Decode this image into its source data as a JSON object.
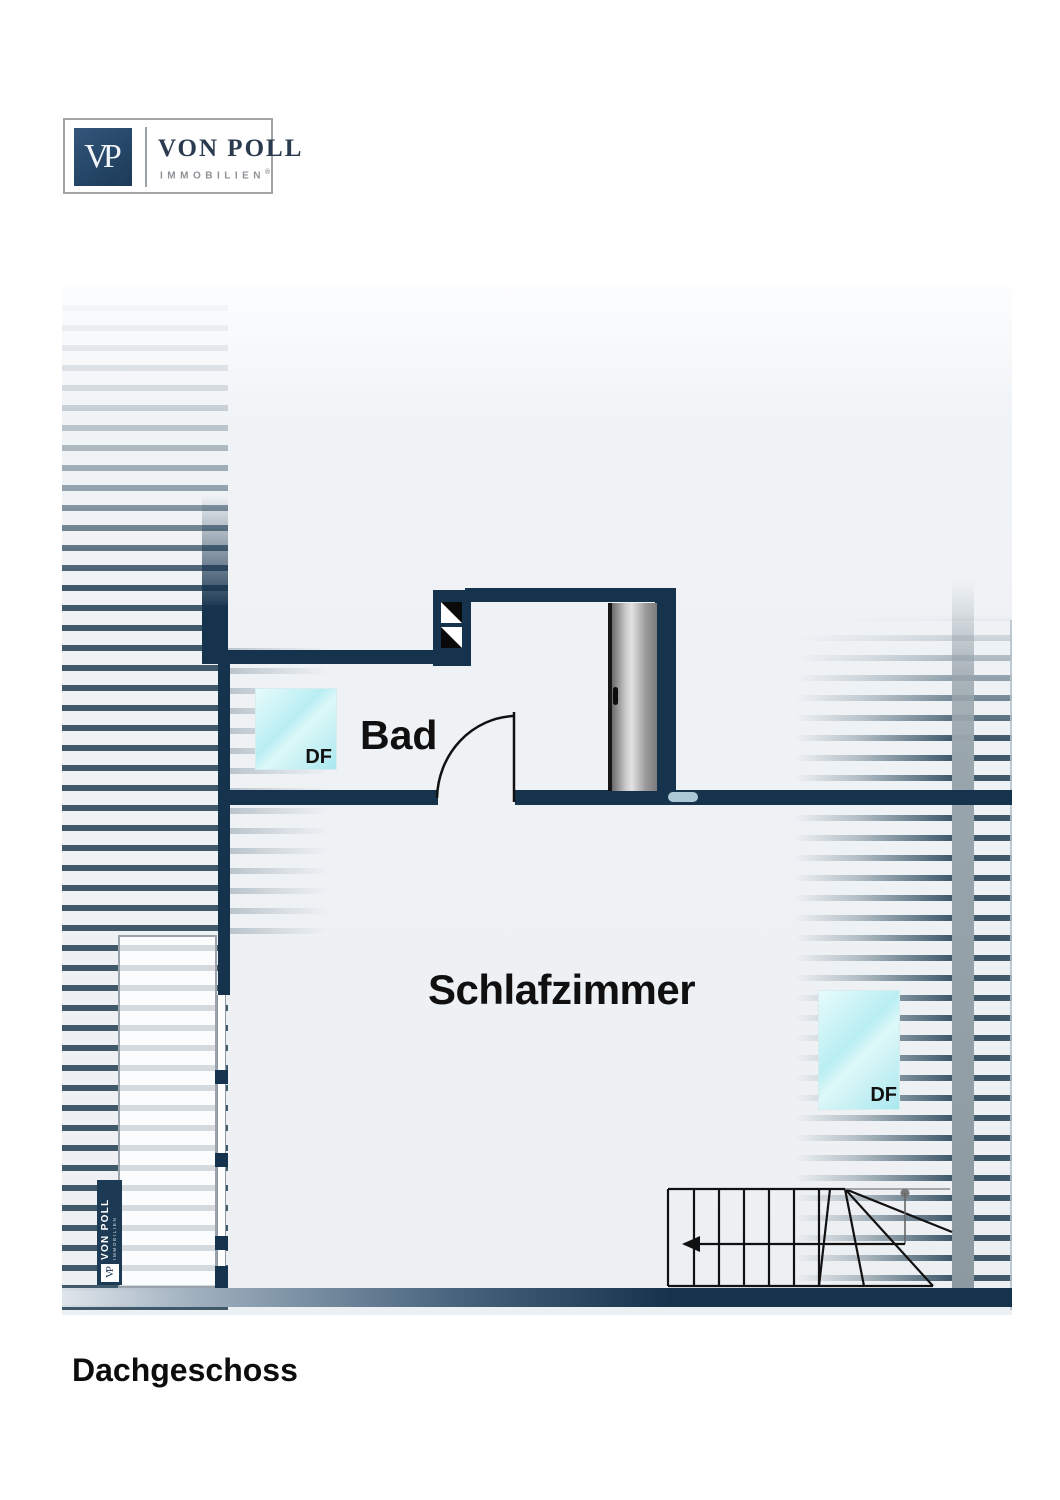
{
  "header_logo": {
    "vp": "VP",
    "name": "VON POLL",
    "subtitle": "IMMOBILIEN",
    "registered": "®"
  },
  "floor_plan": {
    "floor_title": "Dachgeschoss",
    "room_labels": {
      "bathroom": "Bad",
      "bedroom": "Schlafzimmer"
    },
    "skylight_labels": {
      "bathroom": "DF",
      "bedroom": "DF"
    },
    "colors": {
      "wall_navy": "#16334e",
      "hatch_blue": "#3f596b",
      "skylight_cyan": "#b9eef3",
      "door_gray": "#a8a8a8",
      "wall_highlight": "#bcd7e6",
      "logo_navy": "#27496b"
    }
  },
  "watermark_logo": {
    "vp": "VP",
    "name": "VON POLL",
    "subtitle": "IMMOBILIEN"
  }
}
